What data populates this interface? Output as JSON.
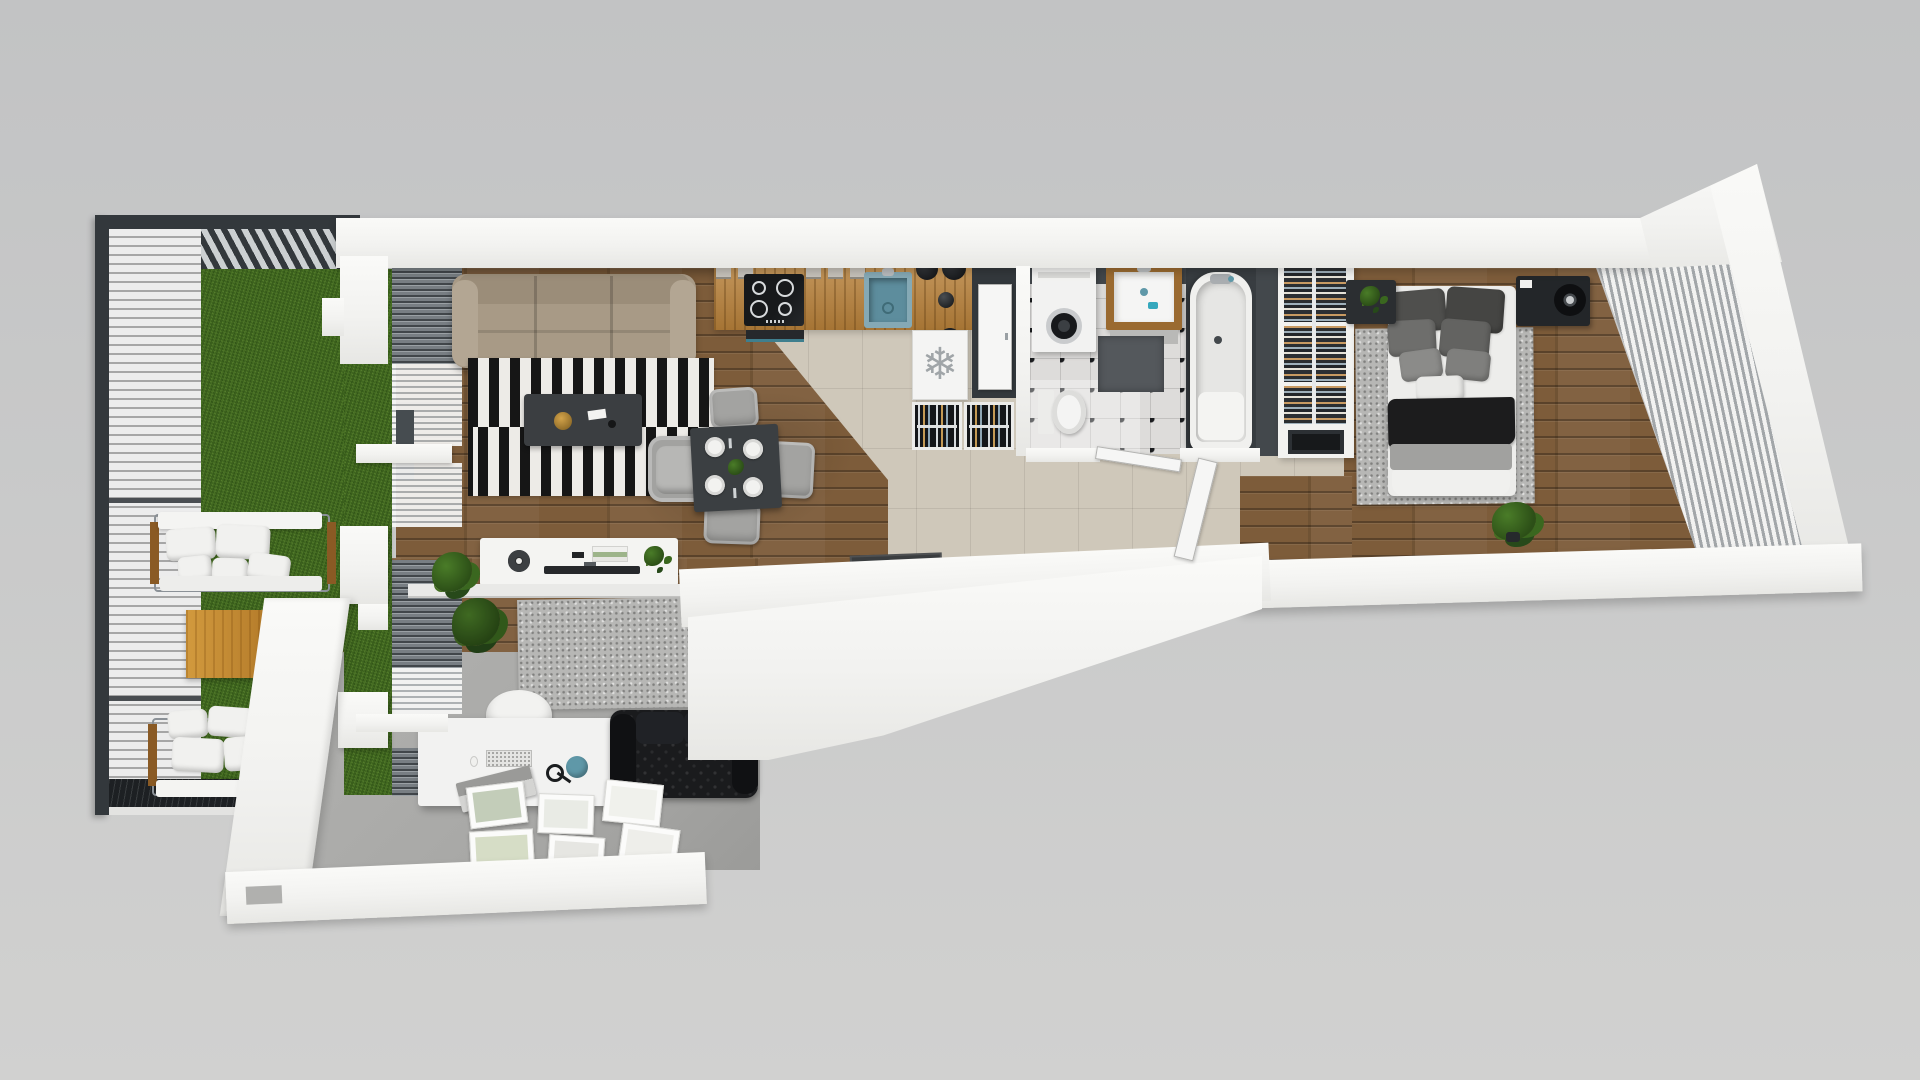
{
  "scene": {
    "label": "3D top-down floor plan render of an apartment with terrace",
    "width": 1920,
    "height": 1080
  },
  "icons": {
    "snowflake_glyph": "❄"
  },
  "palette": {
    "bg_top": "#c2c3c4",
    "bg_bottom": "#d1d1d0",
    "wall": "#f2f2f0",
    "frame_dark": "#33383c",
    "wood": "#7d5c3a",
    "tile": "#cfc8ba",
    "grass": "#477023",
    "deck": "#ececec",
    "deck_gap": "#a6a6a6",
    "dark_deck": "#1d2023",
    "counter": "#b8813a",
    "rug_black": "#161616",
    "rug_white": "#edebe7",
    "sofa_beige": "#a89a86",
    "leather": "#1a1b1d",
    "office_floor": "#a8a8a6",
    "bath_floor": "#dddcda",
    "bath_wall": "#43484c",
    "teal": "#5f98a8",
    "table_wood": "#c08a33",
    "gray_rug": "#b7b7b5"
  },
  "rooms": {
    "terrace": {
      "label": "Terrace — grass, white plank deck, louvered pergola, two outdoor sofas, wooden coffee table"
    },
    "living_room": {
      "label": "Living room — beige sofa, striped rug, coffee table, armchair, sideboard"
    },
    "dining_area": {
      "label": "Dining area — dark table with four place settings and gray chairs"
    },
    "kitchen": {
      "label": "Kitchen — wooden counter, induction hob, teal sink, fridge cabinet, bottle racks"
    },
    "entry": {
      "label": "Entrance door"
    },
    "hallway": {
      "label": "Hallway — beige tiles, doormat"
    },
    "bathroom": {
      "label": "Bathroom — washing machine, washbasin, toilet, bathtub, checkered tiles"
    },
    "wardrobe": {
      "label": "Open wardrobe with hanging clothes and drawer"
    },
    "bedroom": {
      "label": "Bedroom — double bed, gray rug, media cabinet, blinds on slanted glass wall"
    },
    "office": {
      "label": "Home office — desk, white chair, chesterfield sofa, picture frames on floor"
    }
  },
  "furniture": {
    "outdoor_sofa": {
      "label": "Outdoor sofa with white cushions"
    },
    "outdoor_table": {
      "label": "Wooden outdoor coffee table"
    },
    "sofa": {
      "label": "Beige three-seat sofa"
    },
    "striped_rug": {
      "label": "Black and white striped rug"
    },
    "coffee_table": {
      "label": "Dark coffee table with gold bowl"
    },
    "armchair": {
      "label": "Gray armchair"
    },
    "dining_table": {
      "label": "Dining table with four place settings"
    },
    "sideboard": {
      "label": "White sideboard with lamp, books, plant and TV"
    },
    "counter": {
      "label": "Wooden kitchen counter"
    },
    "cooktop": {
      "label": "Induction cooktop with four burners"
    },
    "sink": {
      "label": "Teal kitchen sink"
    },
    "fridge": {
      "label": "Refrigerator cabinet marked with snowflake"
    },
    "bottle_rack": {
      "label": "Pull-out bottle rack"
    },
    "washing_machine": {
      "label": "Washing machine"
    },
    "vanity": {
      "label": "Wood-framed washbasin"
    },
    "toilet": {
      "label": "Toilet"
    },
    "bathtub": {
      "label": "Bathtub"
    },
    "bed": {
      "label": "Double bed with gray pillows and black throw"
    },
    "bed_rug": {
      "label": "Speckled gray rug"
    },
    "nightstand": {
      "label": "Black nightstand with plant"
    },
    "media_cabinet": {
      "label": "Black media cabinet with speaker"
    },
    "desk": {
      "label": "White desk with keyboard, laptop, mouse and headphones"
    },
    "office_chair": {
      "label": "White chair"
    },
    "office_sofa": {
      "label": "Black chesterfield sofa"
    },
    "office_rug": {
      "label": "Gray office rug"
    },
    "floor_frames": {
      "label": "Picture frames lying on the floor"
    },
    "doormat": {
      "label": "Dark doormat"
    }
  }
}
